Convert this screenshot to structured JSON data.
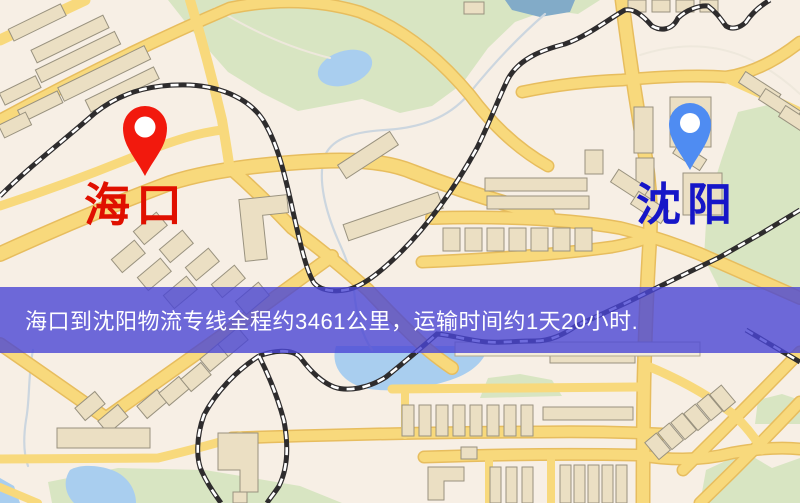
{
  "map": {
    "title": "海口到沈阳物流专线地图",
    "markers": [
      {
        "id": "haikou",
        "label": "海口",
        "pin_color": "#f2190d",
        "label_color": "#e01000"
      },
      {
        "id": "shenyang",
        "label": "沈阳",
        "pin_color": "#4f8cf2",
        "label_color": "#1616c8"
      }
    ],
    "banner": {
      "text": "海口到沈阳物流专线全程约3461公里，运输时间约1天20小时.",
      "bg_color": "#4a46d5",
      "bg_opacity": "0.8",
      "text_color": "#ffffff",
      "distance_km": "3461",
      "duration": "1天20小时"
    },
    "colors": {
      "land": "#f7efe5",
      "park": "#d8e5c2",
      "water": "#a9ceef",
      "pond_dark": "#82abc8",
      "road": "#f8d97c",
      "road_casing": "#e7bd5e",
      "railway": "#2e2c2d",
      "building": "#ebdfc3",
      "building_outline": "#99927f"
    }
  }
}
